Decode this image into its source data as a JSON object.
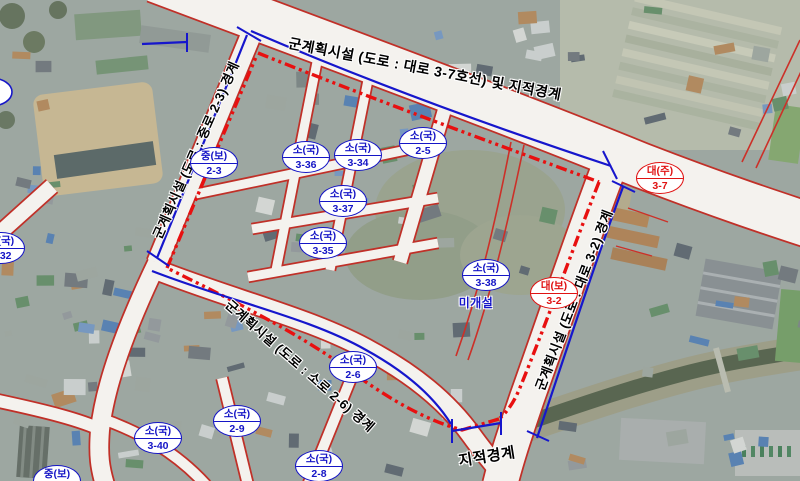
{
  "labels": {
    "top_boundary": "군계획시설 (도로 : 대로 3-7호선) 및 지적경계",
    "left_boundary": "군계획시설 (도로 : 중로 2-3) 경계",
    "right_boundary": "군계획시설 (도로 : 대로 3-2) 경계",
    "bottom_boundary": "군계획시설 (도로 : 소로 2-6) 경계",
    "cadastral": "지적경계",
    "unopened": "미개설"
  },
  "markers": [
    {
      "top": "중(보)",
      "bottom": "2-3",
      "type": "blue",
      "x": 213,
      "y": 162
    },
    {
      "top": "소(국)",
      "bottom": "3-36",
      "type": "blue",
      "x": 305,
      "y": 156
    },
    {
      "top": "소(국)",
      "bottom": "3-34",
      "type": "blue",
      "x": 357,
      "y": 154
    },
    {
      "top": "소(국)",
      "bottom": "2-5",
      "type": "blue",
      "x": 422,
      "y": 142
    },
    {
      "top": "소(국)",
      "bottom": "3-37",
      "type": "blue",
      "x": 342,
      "y": 200
    },
    {
      "top": "소(국)",
      "bottom": "3-35",
      "type": "blue",
      "x": 322,
      "y": 242
    },
    {
      "top": "소(국)",
      "bottom": "3-38",
      "type": "blue",
      "x": 485,
      "y": 274
    },
    {
      "top": "대(주)",
      "bottom": "3-7",
      "type": "red",
      "x": 659,
      "y": 177
    },
    {
      "top": "대(보)",
      "bottom": "3-2",
      "type": "red",
      "x": 553,
      "y": 292
    },
    {
      "top": "소(국)",
      "bottom": "2-6",
      "type": "blue",
      "x": 352,
      "y": 366
    },
    {
      "top": "소(국)",
      "bottom": "2-9",
      "type": "blue",
      "x": 236,
      "y": 420
    },
    {
      "top": "소(국)",
      "bottom": "3-40",
      "type": "blue",
      "x": 157,
      "y": 437
    },
    {
      "top": "소(국)",
      "bottom": "2-8",
      "type": "blue",
      "x": 318,
      "y": 465
    },
    {
      "top": "소(국)",
      "bottom": "3-32",
      "type": "blue",
      "x": 0,
      "y": 247
    },
    {
      "top": "중(보)",
      "bottom": "",
      "type": "blue",
      "x": 56,
      "y": 480
    }
  ],
  "colors": {
    "boundary_dash_red": "#e81010",
    "road_edge_red": "#c03028",
    "road_fill": "#f4f2ee",
    "boundary_blue": "#1616cc",
    "marker_blue": "#1515c6",
    "marker_red": "#e01212",
    "label_text": "#000000"
  }
}
